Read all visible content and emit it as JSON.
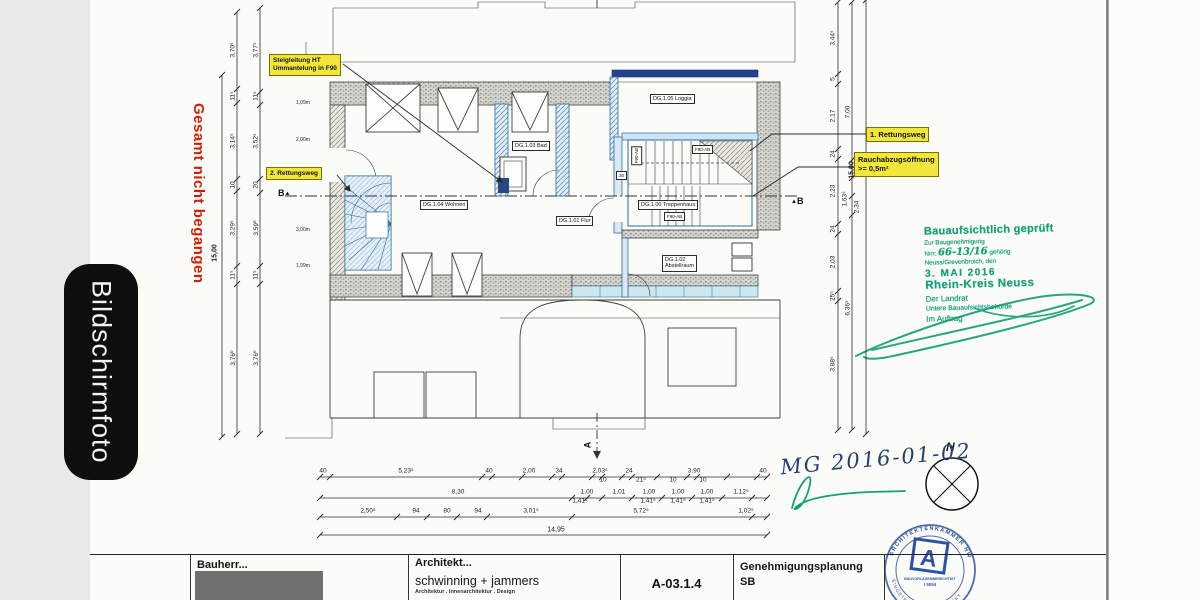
{
  "overlay": {
    "screenshot_label": "Bildschirmfoto",
    "warning_vertical": "Gesamt nicht begangen"
  },
  "plan": {
    "labels": {
      "steigleitung_1": "Steigleitung HT",
      "steigleitung_2": "Ummantelung in F90",
      "rettungsweg_2": "2. Rettungsweg",
      "rettungsweg_1": "1. Rettungsweg",
      "rauchabzug_1": "Rauchabzugsöffnung",
      "rauchabzug_2": ">= 0,5m²"
    },
    "rooms": {
      "loggia": "DG.1.05 Loggia",
      "bad": "DG.1.03 Bad",
      "wohnen": "DG.1.04 Wohnen",
      "flur": "DG.1.01 Flur",
      "treppenhaus": "DG.1.00 Treppenhaus",
      "abstellraum_1": "DG.1.02",
      "abstellraum_2": "Abstellraum",
      "f90_a": "F90-AB",
      "f90_b": "F90-AB",
      "f90_c": "F90-AB",
      "door_width": "30"
    },
    "markers": {
      "section_b_left": "B",
      "section_b_right": "B",
      "section_a": "A",
      "triangle": "▲",
      "north": "N"
    },
    "sill_labels": [
      {
        "t": "1,09m",
        "x": 296,
        "y": 100
      },
      {
        "t": "2,00m",
        "x": 296,
        "y": 137
      },
      {
        "t": "3,00m",
        "x": 296,
        "y": 227
      },
      {
        "t": "1,09m",
        "x": 296,
        "y": 263
      }
    ]
  },
  "dimensions": {
    "left_total": [
      {
        "t": "15,00",
        "x": 215,
        "y": 253,
        "r": -90,
        "s": 7,
        "b": 1
      }
    ],
    "left_outer": [
      {
        "t": "3,70⁵",
        "x": 233,
        "y": 50,
        "r": -90
      },
      {
        "t": "11⁵",
        "x": 233,
        "y": 96,
        "r": -90
      },
      {
        "t": "3,14⁵",
        "x": 233,
        "y": 141,
        "r": -90
      },
      {
        "t": "10",
        "x": 233,
        "y": 185,
        "r": -90
      },
      {
        "t": "3,29⁵",
        "x": 233,
        "y": 228,
        "r": -90
      },
      {
        "t": "11⁵",
        "x": 233,
        "y": 275,
        "r": -90
      },
      {
        "t": "3,76⁰",
        "x": 233,
        "y": 358,
        "r": -90
      }
    ],
    "left_inner": [
      {
        "t": "3,77⁵",
        "x": 256,
        "y": 50,
        "r": -90
      },
      {
        "t": "11⁵",
        "x": 256,
        "y": 96,
        "r": -90
      },
      {
        "t": "3,52⁵",
        "x": 256,
        "y": 141,
        "r": -90
      },
      {
        "t": "20",
        "x": 256,
        "y": 185,
        "r": -90
      },
      {
        "t": "3,59⁰",
        "x": 256,
        "y": 228,
        "r": -90
      },
      {
        "t": "11⁵",
        "x": 256,
        "y": 275,
        "r": -90
      },
      {
        "t": "3,76⁰",
        "x": 256,
        "y": 358,
        "r": -90
      }
    ],
    "right_a": [
      {
        "t": "3,44⁵",
        "x": 833,
        "y": 38,
        "r": -90
      },
      {
        "t": "5",
        "x": 833,
        "y": 79,
        "r": -90
      },
      {
        "t": "2,17",
        "x": 833,
        "y": 116,
        "r": -90
      },
      {
        "t": "24",
        "x": 833,
        "y": 154,
        "r": -90
      },
      {
        "t": "2,23",
        "x": 833,
        "y": 191,
        "r": -90
      },
      {
        "t": "24",
        "x": 833,
        "y": 229,
        "r": -90
      },
      {
        "t": "2,03",
        "x": 833,
        "y": 262,
        "r": -90
      },
      {
        "t": "25⁵",
        "x": 833,
        "y": 296,
        "r": -90
      },
      {
        "t": "3,88⁵",
        "x": 833,
        "y": 364,
        "r": -90
      }
    ],
    "right_b": [
      {
        "t": "7,00",
        "x": 848,
        "y": 112,
        "r": -90
      },
      {
        "t": "15,00",
        "x": 852,
        "y": 170,
        "r": -90,
        "s": 7,
        "b": 1
      },
      {
        "t": "1,63⁵",
        "x": 845,
        "y": 199,
        "r": -90
      },
      {
        "t": "2,34",
        "x": 857,
        "y": 207,
        "r": -90
      },
      {
        "t": "6,36⁵",
        "x": 848,
        "y": 308,
        "r": -90
      }
    ],
    "bottom_r1": [
      {
        "t": "40",
        "x": 323,
        "y": 471
      },
      {
        "t": "5,23⁵",
        "x": 406,
        "y": 471
      },
      {
        "t": "40",
        "x": 489,
        "y": 471
      },
      {
        "t": "2,00",
        "x": 529,
        "y": 471
      },
      {
        "t": "34",
        "x": 559,
        "y": 471
      },
      {
        "t": "2,03⁵",
        "x": 600,
        "y": 471
      },
      {
        "t": "24",
        "x": 629,
        "y": 471
      },
      {
        "t": "3,90",
        "x": 694,
        "y": 471
      },
      {
        "t": "40",
        "x": 763,
        "y": 471
      },
      {
        "t": "10",
        "x": 603,
        "y": 480
      },
      {
        "t": "21⁵",
        "x": 641,
        "y": 480
      },
      {
        "t": "10",
        "x": 673,
        "y": 480
      },
      {
        "t": "10",
        "x": 703,
        "y": 480
      }
    ],
    "bottom_r2": [
      {
        "t": "8,30",
        "x": 458,
        "y": 492
      },
      {
        "t": "1,00",
        "x": 587,
        "y": 492
      },
      {
        "t": "1,01",
        "x": 619,
        "y": 492
      },
      {
        "t": "1,00",
        "x": 649,
        "y": 492
      },
      {
        "t": "1,00",
        "x": 678,
        "y": 492
      },
      {
        "t": "1,00",
        "x": 707,
        "y": 492
      },
      {
        "t": "1,12⁵",
        "x": 741,
        "y": 492
      },
      {
        "t": "1,41⁵",
        "x": 580,
        "y": 501
      },
      {
        "t": "1,41⁵",
        "x": 648,
        "y": 501
      },
      {
        "t": "1,41⁵",
        "x": 678,
        "y": 501
      },
      {
        "t": "1,41⁵",
        "x": 707,
        "y": 501
      }
    ],
    "bottom_r3": [
      {
        "t": "2,50⁵",
        "x": 368,
        "y": 511
      },
      {
        "t": "94",
        "x": 416,
        "y": 511
      },
      {
        "t": "80",
        "x": 447,
        "y": 511
      },
      {
        "t": "94",
        "x": 478,
        "y": 511
      },
      {
        "t": "3,01⁵",
        "x": 531,
        "y": 511
      },
      {
        "t": "5,72⁵",
        "x": 641,
        "y": 511
      },
      {
        "t": "1,02⁵",
        "x": 746,
        "y": 511
      }
    ],
    "bottom_total": [
      {
        "t": "14,95",
        "x": 556,
        "y": 530,
        "s": 7
      }
    ]
  },
  "stamps": {
    "approval": {
      "title": "Bauaufsichtlich geprüft",
      "sub1": "Zur Baugenehmigung",
      "sub2": "Nrn:",
      "sub2_hand": "66-13/16",
      "sub2_tail": "gehörig",
      "sub3": "Neuss/Grevenbroich, den",
      "date": "3. MAI 2016",
      "authority": "Rhein-Kreis Neuss",
      "role": "Der Landrat",
      "dept": "Untere Bauaufsichtsbehörde",
      "by": "Im Auftrag"
    },
    "handwritten": {
      "date_note": "MG 2016-01-02"
    },
    "seal": {
      "ring_top": "ARCHITEKTENKAMMER NW",
      "ring_bottom": "EINGETRAGENER ARCHITEKT",
      "center_letter": "A",
      "line1": "BAUVORLAGENBERECHTIGT",
      "line2": "I 5094"
    }
  },
  "titleblock": {
    "bauherr_label": "Bauherr...",
    "architekt_label": "Architekt...",
    "firm": "schwinning + jammers",
    "firm_sub": "Architektur . Innenarchitektur . Design",
    "sheet": "A-03.1.4",
    "phase_line1": "Genehmigungsplanung",
    "phase_line2": "SB"
  }
}
